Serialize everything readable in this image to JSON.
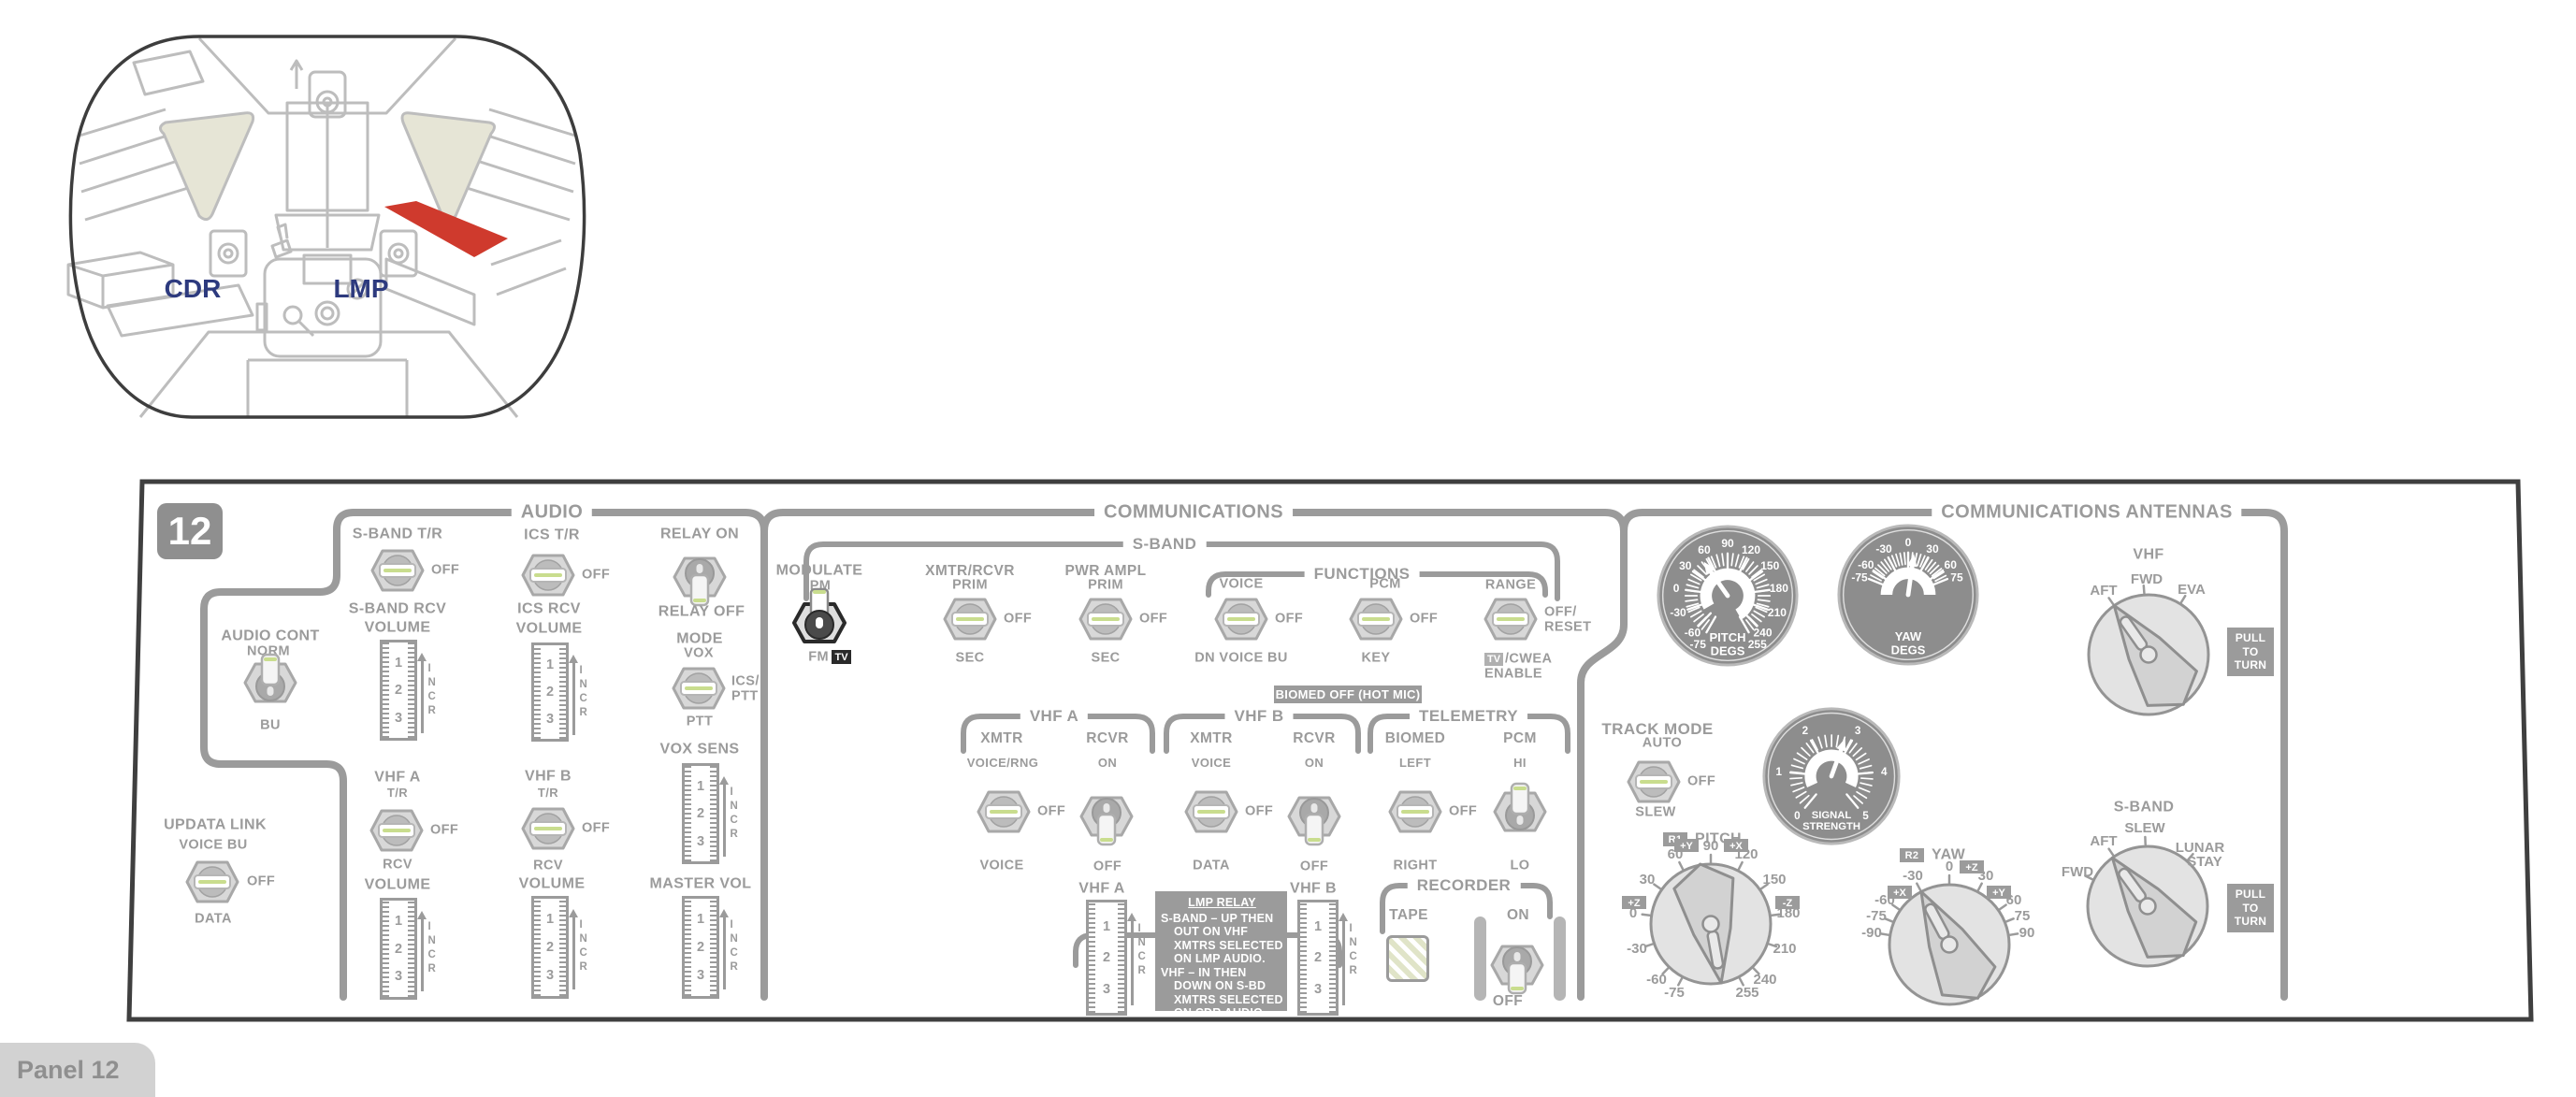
{
  "badge": "12",
  "tab": "Panel 12",
  "marks": [
    "1",
    "2",
    "3"
  ],
  "incr": "INCR",
  "inset": {
    "cdr": "CDR",
    "lmp": "LMP"
  },
  "audio": {
    "title": "AUDIO",
    "cont": {
      "label": "AUDIO CONT",
      "up": "NORM",
      "down": "BU"
    },
    "updata": {
      "label": "UPDATA LINK",
      "up": "VOICE BU",
      "right": "OFF",
      "down": "DATA"
    },
    "sband_tr": {
      "up": "S-BAND T/R",
      "right": "OFF",
      "down": "S-BAND RCV"
    },
    "ics_tr": {
      "up": "ICS T/R",
      "right": "OFF",
      "down": "ICS RCV"
    },
    "vhfa_tr": {
      "up": "VHF A",
      "sub": "T/R",
      "right": "OFF",
      "down": "RCV"
    },
    "vhfb_tr": {
      "up": "VHF B",
      "sub": "T/R",
      "right": "OFF",
      "down": "RCV"
    },
    "relay": {
      "up": "RELAY ON",
      "down": "RELAY OFF"
    },
    "mode": {
      "label": "MODE",
      "up": "VOX",
      "right1": "ICS/",
      "right2": "PTT",
      "down": "PTT"
    },
    "volume_label": "VOLUME",
    "vox_sens_label": "VOX SENS",
    "master_vol_label": "MASTER VOL"
  },
  "comm": {
    "title": "COMMUNICATIONS",
    "sband": "S-BAND",
    "functions": "FUNCTIONS",
    "modulate": {
      "label": "MODULATE",
      "up": "PM",
      "down_fm": "FM",
      "down_tv": "TV"
    },
    "xmtr_rcvr": {
      "label": "XMTR/RCVR",
      "up": "PRIM",
      "right": "OFF",
      "down": "SEC"
    },
    "pwr_ampl": {
      "label": "PWR AMPL",
      "up": "PRIM",
      "right": "OFF",
      "down": "SEC"
    },
    "voice": {
      "up": "VOICE",
      "right": "OFF",
      "down": "DN VOICE BU"
    },
    "pcm": {
      "up": "PCM",
      "right": "OFF",
      "down": "KEY"
    },
    "range": {
      "up": "RANGE",
      "right1": "OFF/",
      "right2": "RESET",
      "down_tv": "TV",
      "down1": "/CWEA",
      "down2": "ENABLE"
    },
    "biomed_badge": "BIOMED OFF (HOT MIC)",
    "vhfa": {
      "title": "VHF A",
      "xmtr": {
        "up": "XMTR",
        "sub": "VOICE/RNG",
        "right": "OFF",
        "down": "VOICE"
      },
      "rcvr": {
        "up": "RCVR",
        "sub": "ON",
        "down": "OFF"
      }
    },
    "vhfb": {
      "title": "VHF B",
      "xmtr": {
        "up": "XMTR",
        "sub": "VOICE",
        "right": "OFF",
        "down": "DATA"
      },
      "rcvr": {
        "up": "RCVR",
        "sub": "ON",
        "down": "OFF"
      }
    },
    "telemetry": {
      "title": "TELEMETRY",
      "biomed": {
        "up": "BIOMED",
        "sub": "LEFT",
        "right": "OFF",
        "down": "RIGHT"
      },
      "pcm": {
        "up": "PCM",
        "sub": "HI",
        "down": "LO"
      }
    },
    "squelch": {
      "title": "SQUELCH",
      "vhfa": "VHF A",
      "vhfb": "VHF B"
    },
    "lmp_relay": {
      "title": "LMP RELAY",
      "lines": [
        "S-BAND – UP THEN",
        "OUT ON VHF",
        "XMTRS SELECTED",
        "ON LMP AUDIO.",
        "VHF – IN THEN",
        "DOWN ON S-BD",
        "XMTRS SELECTED",
        "ON CDR AUDIO"
      ]
    },
    "recorder": {
      "title": "RECORDER",
      "tape": "TAPE",
      "on": "ON",
      "off": "OFF"
    }
  },
  "ant": {
    "title": "COMMUNICATIONS ANTENNAS",
    "pitch_gauge": {
      "name1": "PITCH",
      "name2": "DEGS",
      "scale": [
        "-75",
        "-60",
        "-30",
        "0",
        "30",
        "60",
        "90",
        "120",
        "150",
        "180",
        "210",
        "240",
        "255"
      ]
    },
    "yaw_gauge": {
      "name1": "YAW",
      "name2": "DEGS",
      "scale": [
        "-75",
        "-60",
        "-30",
        "0",
        "30",
        "60",
        "75"
      ]
    },
    "signal_gauge": {
      "name1": "SIGNAL",
      "name2": "STRENGTH",
      "scale": [
        "0",
        "1",
        "2",
        "3",
        "4",
        "5"
      ]
    },
    "track": {
      "label": "TRACK MODE",
      "up": "AUTO",
      "right": "OFF",
      "down": "SLEW"
    },
    "vhf_knob": {
      "title": "VHF",
      "pos": [
        "AFT",
        "FWD",
        "EVA"
      ]
    },
    "sband_knob": {
      "title": "S-BAND",
      "pos": [
        "FWD",
        "AFT",
        "SLEW",
        "LUNAR",
        "STAY"
      ]
    },
    "r1": {
      "badge": "R1",
      "label": "PITCH",
      "scale": [
        "-75",
        "-60",
        "-30",
        "0",
        "30",
        "60",
        "90",
        "120",
        "150",
        "180",
        "210",
        "240",
        "255"
      ],
      "axis": [
        "+Y",
        "+X",
        "-Z",
        "+Z"
      ]
    },
    "r2": {
      "badge": "R2",
      "label": "YAW",
      "scale": [
        "-90",
        "-75",
        "-60",
        "-30",
        "0",
        "30",
        "60",
        "75",
        "90"
      ],
      "axis": [
        "+X",
        "+Z",
        "+Y"
      ]
    },
    "pull": "PULL TO TURN"
  }
}
